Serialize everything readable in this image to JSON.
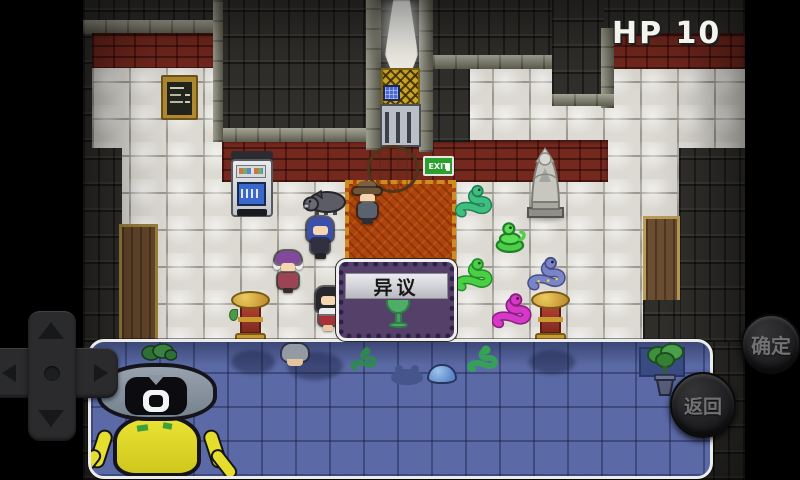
{
  "hud": {
    "hp": "HP 10"
  },
  "dialog": {
    "title": "异议"
  },
  "exit_sign": {
    "label": "EXIT"
  },
  "touch_controls": {
    "confirm_label": "确定",
    "back_label": "返回"
  },
  "palette": {
    "water": "#5b6aa6",
    "floor_tile": "#dcdad2",
    "red_brick": "#74281e",
    "dark_brick": "#302f2c",
    "carpet": "#ad430d",
    "dialog_body": "#55406a",
    "dialog_band": "#d6d6dc",
    "gold_lattice": "#c9a427",
    "hp_text": "#f4f4ef",
    "snake_teal": "#3fbf7f",
    "snake_lime": "#4ccf45",
    "snake_blue": "#7a85c8",
    "snake_magenta": "#d838c8",
    "cyclops_yellow": "#e4dc28",
    "statue_stone": "#c4c4be",
    "goblet_green": "#4fae66"
  }
}
